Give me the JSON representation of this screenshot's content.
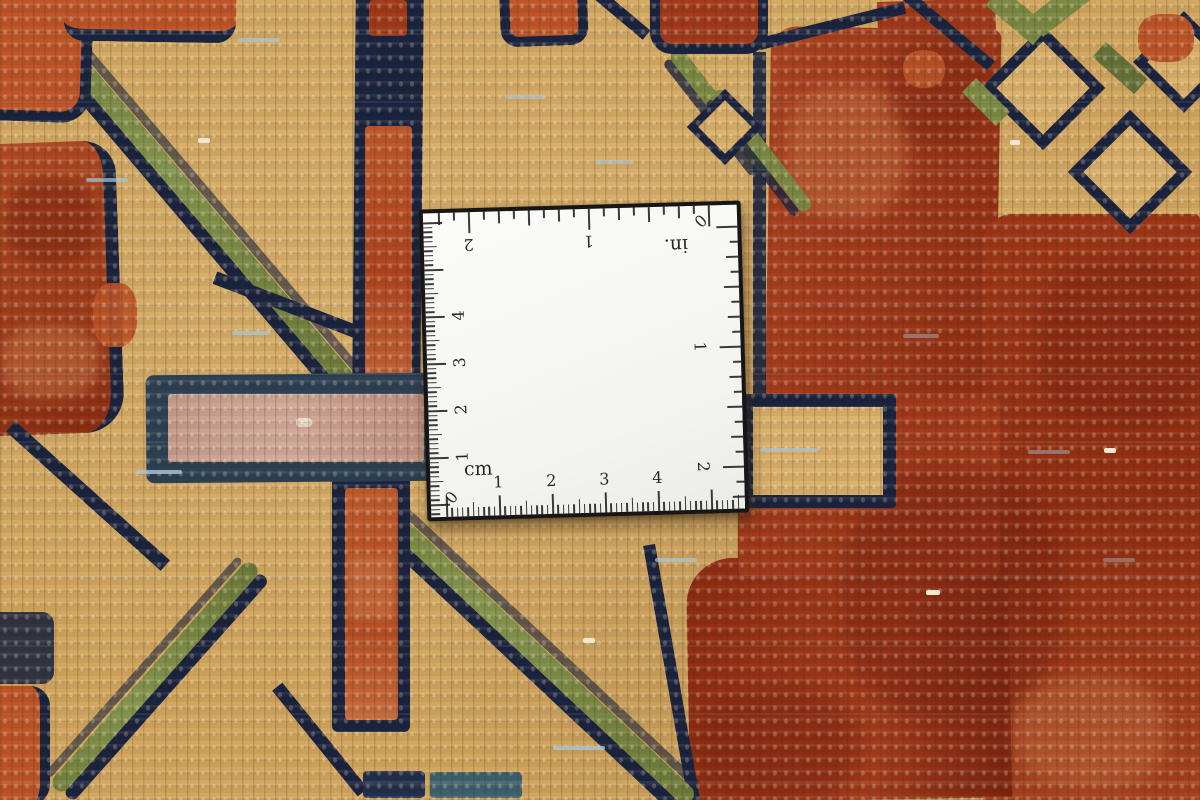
{
  "scene": {
    "description": "Close-up photograph of a hand-knotted wool rug pile with a square white measuring scale card lying on it",
    "subject": "carpet weave detail with ruler card",
    "rug_motifs": [
      "tan field",
      "navy-outlined leaf and diamond motifs",
      "olive green diagonal stems",
      "rust red blossom masses",
      "dusty pink bar",
      "orange stripes"
    ]
  },
  "ruler": {
    "type": "square scale card",
    "metric": {
      "label": "cm",
      "zero": "0",
      "numbers": [
        "1",
        "2",
        "3",
        "4"
      ]
    },
    "imperial": {
      "label": "in.",
      "zero": "0",
      "numbers": [
        "1",
        "2"
      ]
    }
  },
  "palette": {
    "tan_field": "#d3a75f",
    "tan_light": "#dcb26c",
    "navy_outline": "#1a2440",
    "navy_soft": "#22304e",
    "olive_green": "#7c8b45",
    "olive_dark": "#66753a",
    "rust_red": "#a23a1b",
    "rust_dark": "#7c2410",
    "orange_flower": "#bf5528",
    "salmon": "#cf7a4a",
    "dusty_pink": "#c89e8f",
    "pink_outline": "#2d4257",
    "teal_accent": "#3f6270",
    "sky_weft": "#a9c6d6",
    "cream_fleck": "#f0e6d2",
    "card_white": "#f7f7f5",
    "card_border": "#161616",
    "tick_color": "#1f1f1f"
  }
}
